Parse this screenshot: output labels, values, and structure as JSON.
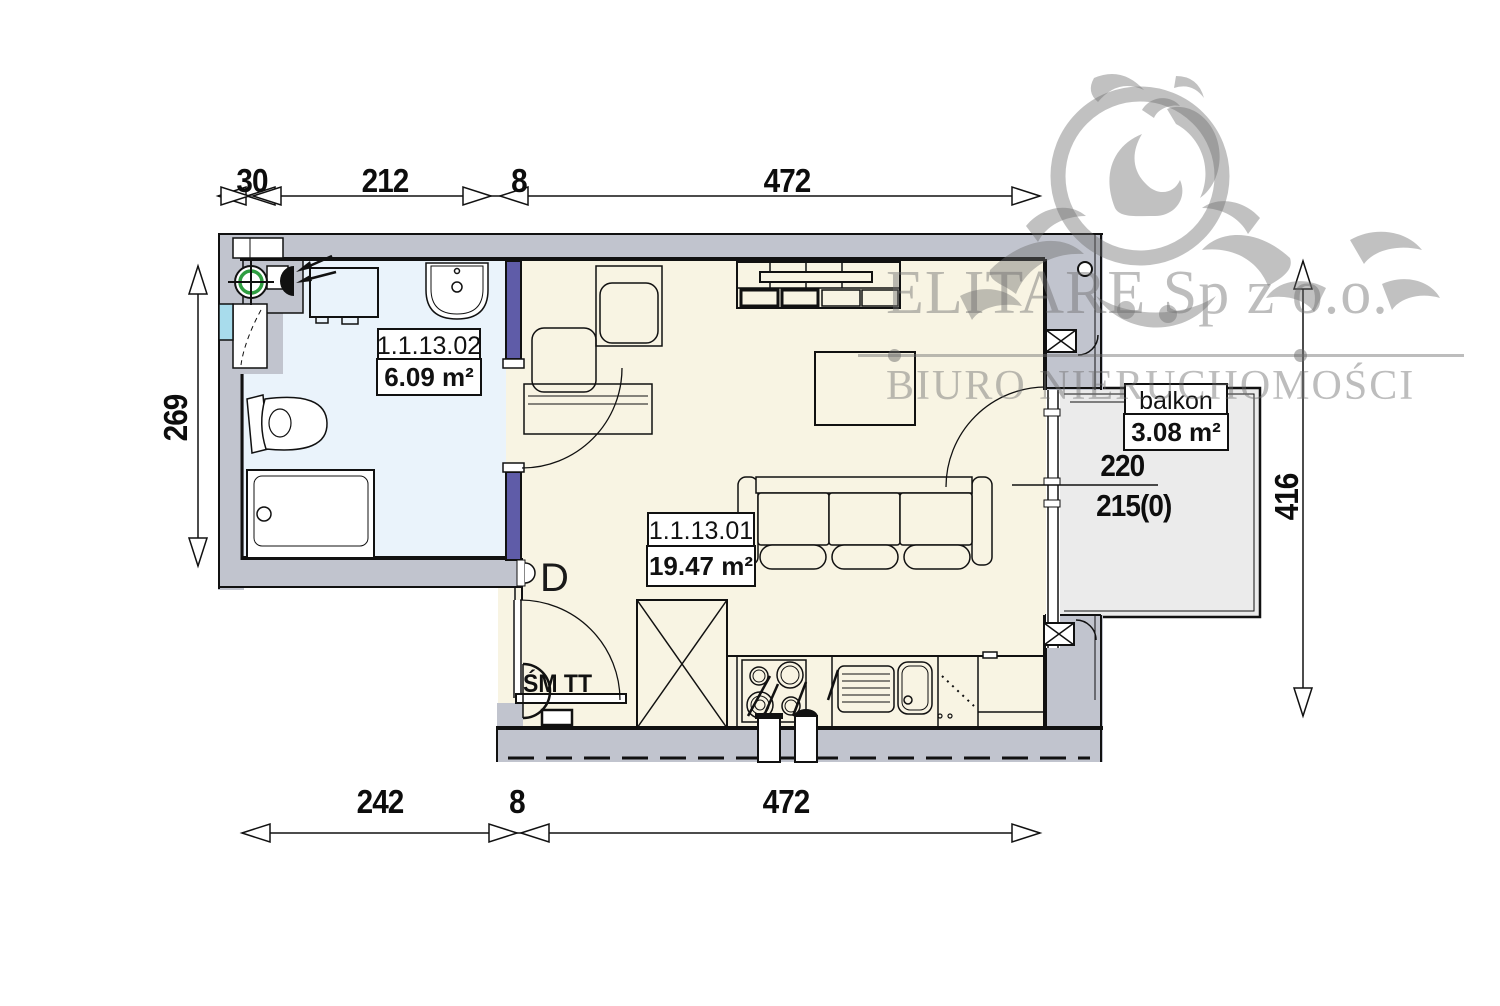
{
  "watermark": {
    "company": "ELITARE Sp z o.o.",
    "subtitle": "BIURO NIERUCHOMOŚCI"
  },
  "rooms": {
    "bathroom": {
      "id": "1.1.13.02",
      "area": "6.09 m²"
    },
    "living": {
      "id": "1.1.13.01",
      "area": "19.47 m²"
    },
    "balcony": {
      "name": "balkon",
      "area": "3.08 m²"
    }
  },
  "dimensions": {
    "top": {
      "d1": "30",
      "d2": "212",
      "d3": "8",
      "d4": "472"
    },
    "bottom": {
      "d1": "242",
      "d2": "8",
      "d3": "472"
    },
    "left": {
      "d1": "269"
    },
    "right": {
      "d1": "416"
    },
    "window": {
      "width": "220",
      "sill": "215(0)"
    }
  },
  "annotations": {
    "door": "D",
    "meters": "ŚM TT"
  },
  "colors": {
    "wall": "#c1c4ce",
    "bathroom_floor": "#eaf3fb",
    "living_floor": "#f8f4e3",
    "balcony_floor": "#ebebeb",
    "door_jamb": "#5f5ca8",
    "vent_green": "#2f9e41",
    "window_cyan": "#a8dcec"
  }
}
